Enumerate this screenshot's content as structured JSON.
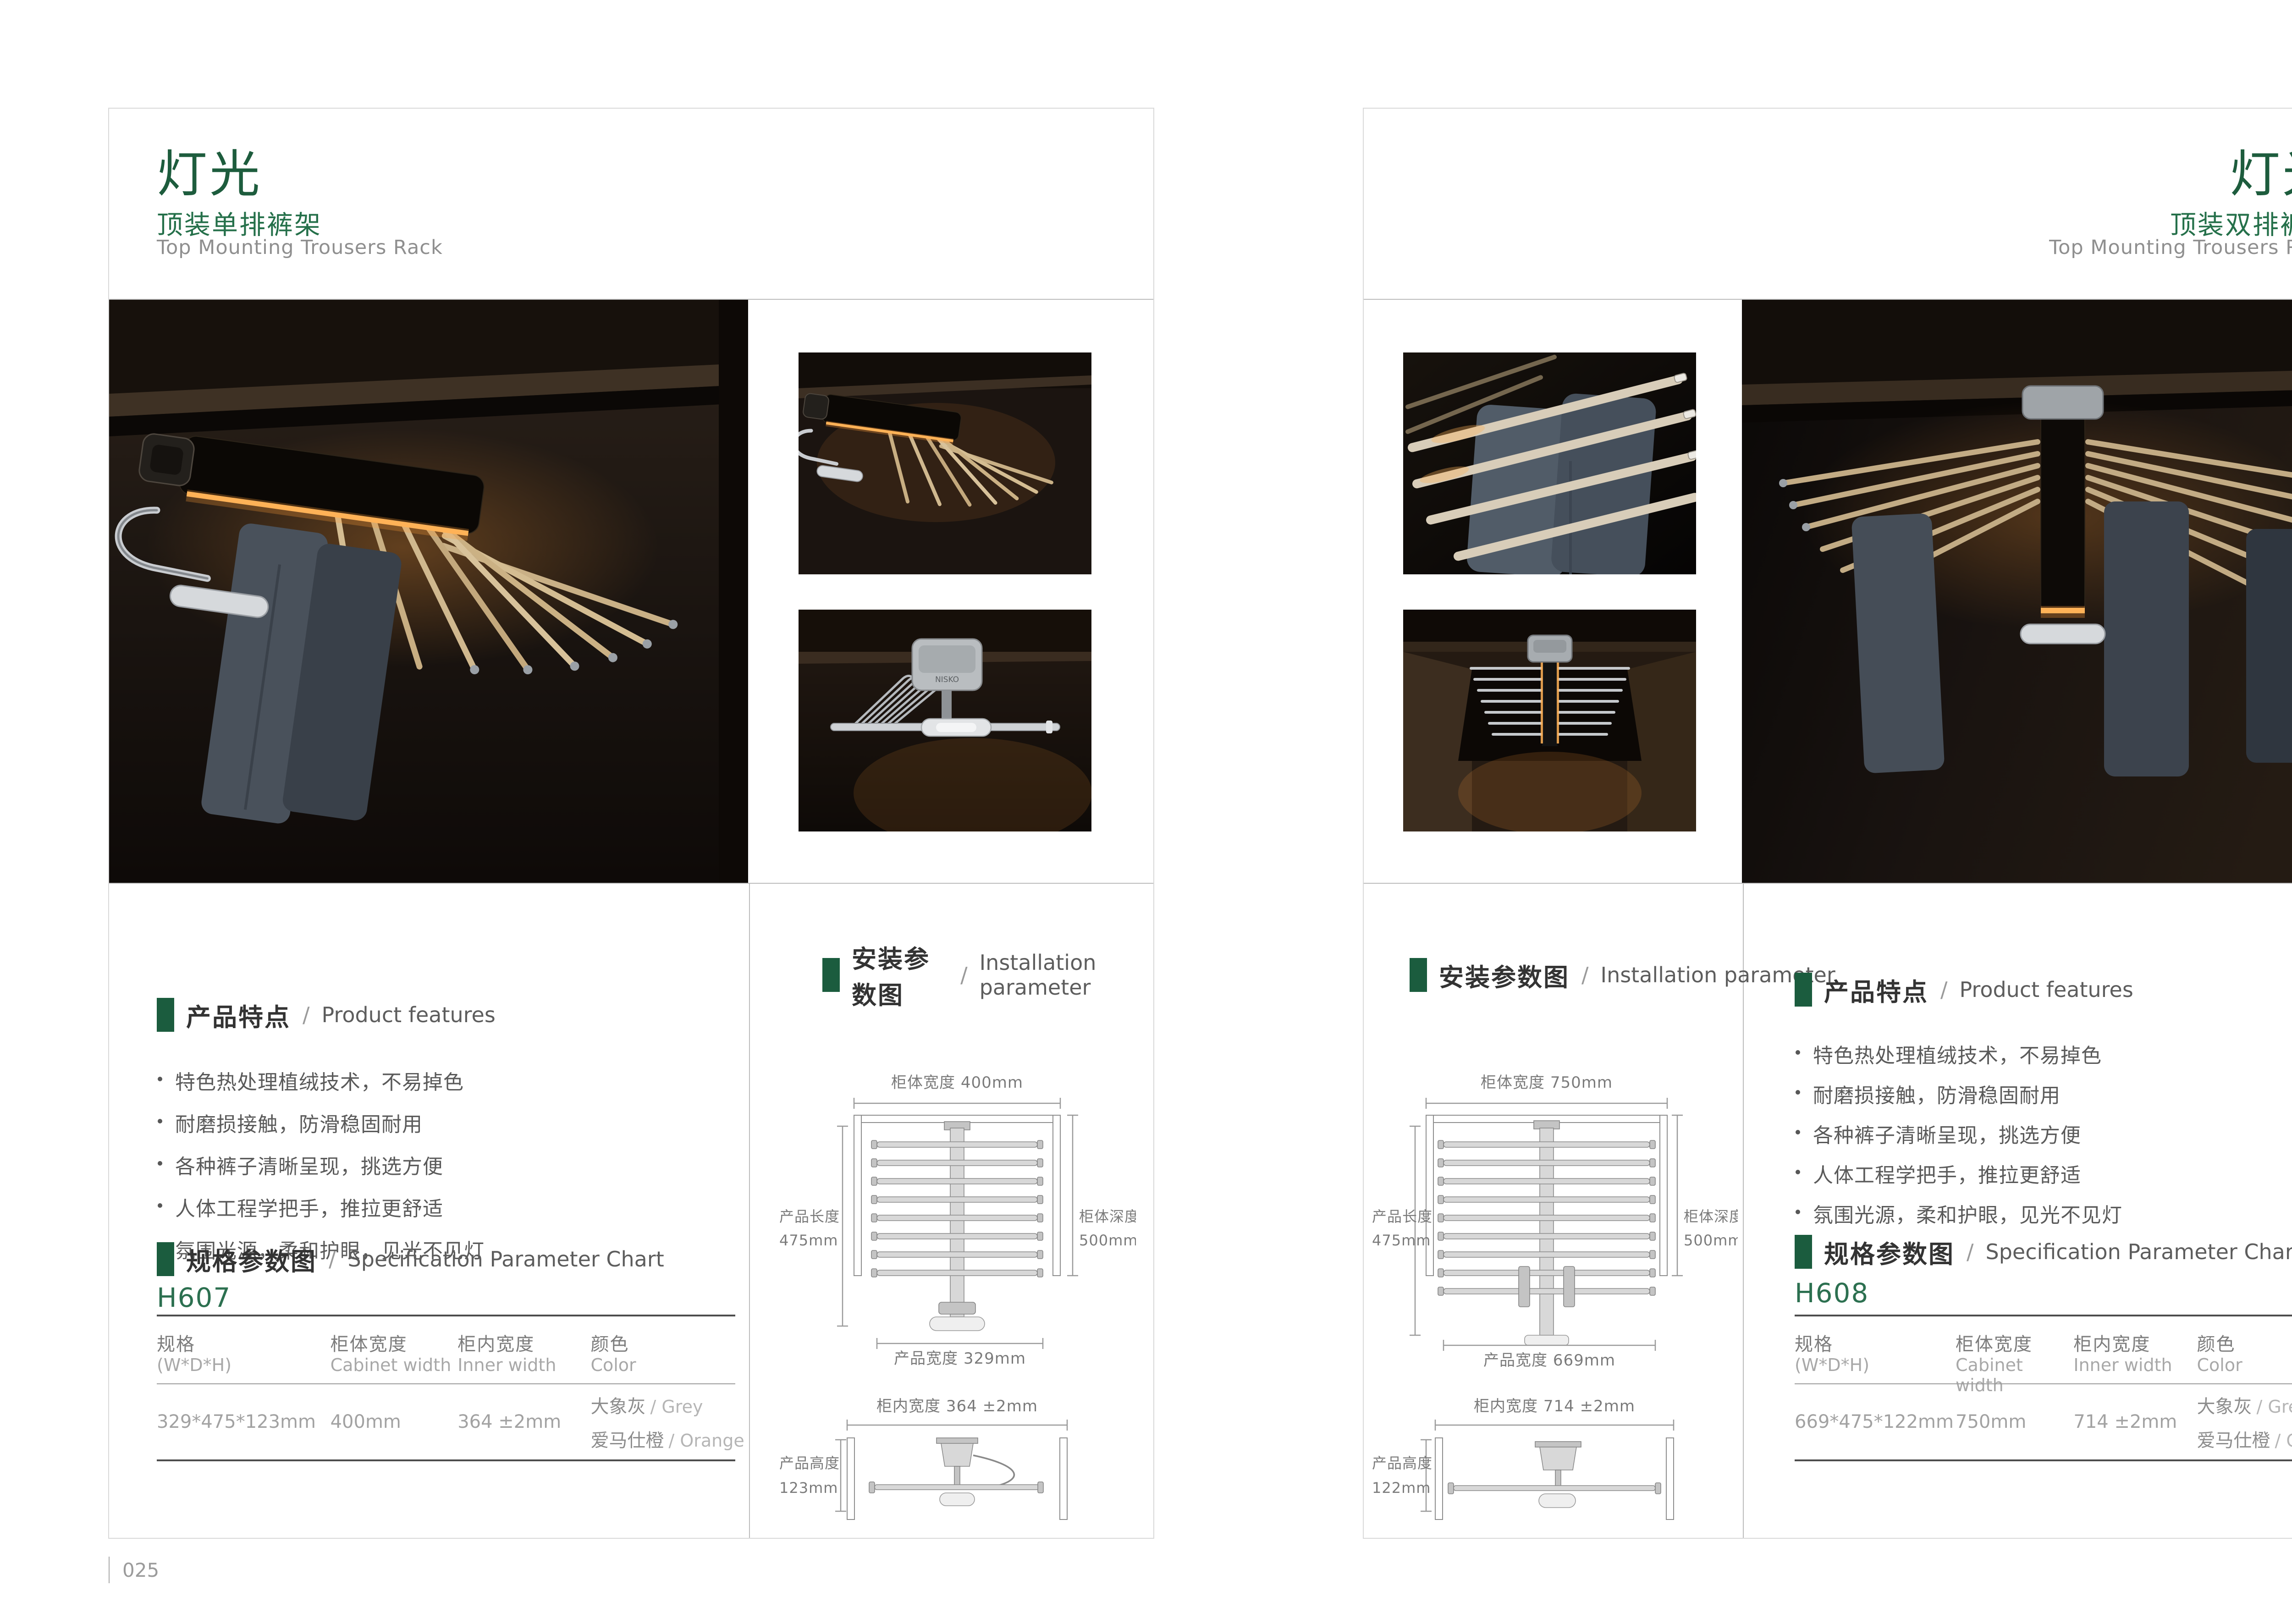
{
  "theme": {
    "accent_green": "#1b5c3e",
    "model_green": "#2c7050",
    "heading_text": "#333333",
    "body_text": "#5a5a5a",
    "muted_text": "#9a9a9a",
    "border_gray": "#c9c9c9",
    "led_warm": "#f2a94e"
  },
  "pages": [
    {
      "page_number": "025",
      "header": {
        "title": "灯光",
        "subtitle": "顶装单排裤架",
        "subtitle_en": "Top Mounting Trousers Rack"
      },
      "photos": {
        "brand_mark": "NISKO"
      },
      "features": {
        "label_cn": "产品特点",
        "sep": "/",
        "label_en": "Product features",
        "items": [
          "特色热处理植绒技术，不易掉色",
          "耐磨损接触，防滑稳固耐用",
          "各种裤子清晰呈现，挑选方便",
          "人体工程学把手，推拉更舒适",
          "氛围光源，柔和护眼，见光不见灯"
        ]
      },
      "spec": {
        "label_cn": "规格参数图",
        "sep": "/",
        "label_en": "Specification Parameter Chart",
        "model": "H607",
        "table": {
          "headers": [
            {
              "cn": "规格",
              "en": "(W*D*H)"
            },
            {
              "cn": "柜体宽度",
              "en": "Cabinet width"
            },
            {
              "cn": "柜内宽度",
              "en": "Inner width"
            },
            {
              "cn": "颜色",
              "en": "Color"
            }
          ],
          "row": {
            "dimensions": "329*475*123mm",
            "cabinet_width": "400mm",
            "inner_width": "364 ±2mm",
            "colors": [
              {
                "cn": "大象灰",
                "en": "/ Grey"
              },
              {
                "cn": "爱马仕橙",
                "en": "/ Orange"
              }
            ]
          }
        }
      },
      "installation": {
        "label_cn": "安装参数图",
        "sep": "/",
        "label_en": "Installation parameter",
        "diagram_top": {
          "cabinet_width": "柜体宽度 400mm",
          "product_length_cn": "产品长度",
          "product_length_val": "475mm",
          "cabinet_depth_cn": "柜体深度",
          "cabinet_depth_val": "500mm",
          "product_width": "产品宽度 329mm"
        },
        "diagram_side": {
          "inner_width": "柜内宽度 364 ±2mm",
          "product_height_cn": "产品高度",
          "product_height_val": "123mm"
        }
      }
    },
    {
      "page_number": "026",
      "header": {
        "title": "灯光",
        "subtitle": "顶装双排裤架",
        "subtitle_en": "Top Mounting Trousers Rack"
      },
      "features": {
        "label_cn": "产品特点",
        "sep": "/",
        "label_en": "Product features",
        "items": [
          "特色热处理植绒技术，不易掉色",
          "耐磨损接触，防滑稳固耐用",
          "各种裤子清晰呈现，挑选方便",
          "人体工程学把手，推拉更舒适",
          "氛围光源，柔和护眼，见光不见灯"
        ]
      },
      "spec": {
        "label_cn": "规格参数图",
        "sep": "/",
        "label_en": "Specification Parameter Chart",
        "model": "H608",
        "table": {
          "headers": [
            {
              "cn": "规格",
              "en": "(W*D*H)"
            },
            {
              "cn": "柜体宽度",
              "en": "Cabinet width"
            },
            {
              "cn": "柜内宽度",
              "en": "Inner width"
            },
            {
              "cn": "颜色",
              "en": "Color"
            }
          ],
          "row": {
            "dimensions": "669*475*122mm",
            "cabinet_width": "750mm",
            "inner_width": "714 ±2mm",
            "colors": [
              {
                "cn": "大象灰",
                "en": "/ Grey"
              },
              {
                "cn": "爱马仕橙",
                "en": "/ Orange"
              }
            ]
          }
        }
      },
      "installation": {
        "label_cn": "安装参数图",
        "sep": "/",
        "label_en": "Installation parameter",
        "diagram_top": {
          "cabinet_width": "柜体宽度 750mm",
          "product_length_cn": "产品长度",
          "product_length_val": "475mm",
          "cabinet_depth_cn": "柜体深度",
          "cabinet_depth_val": "500mm",
          "product_width": "产品宽度 669mm"
        },
        "diagram_side": {
          "inner_width": "柜内宽度 714 ±2mm",
          "product_height_cn": "产品高度",
          "product_height_val": "122mm"
        }
      }
    }
  ]
}
